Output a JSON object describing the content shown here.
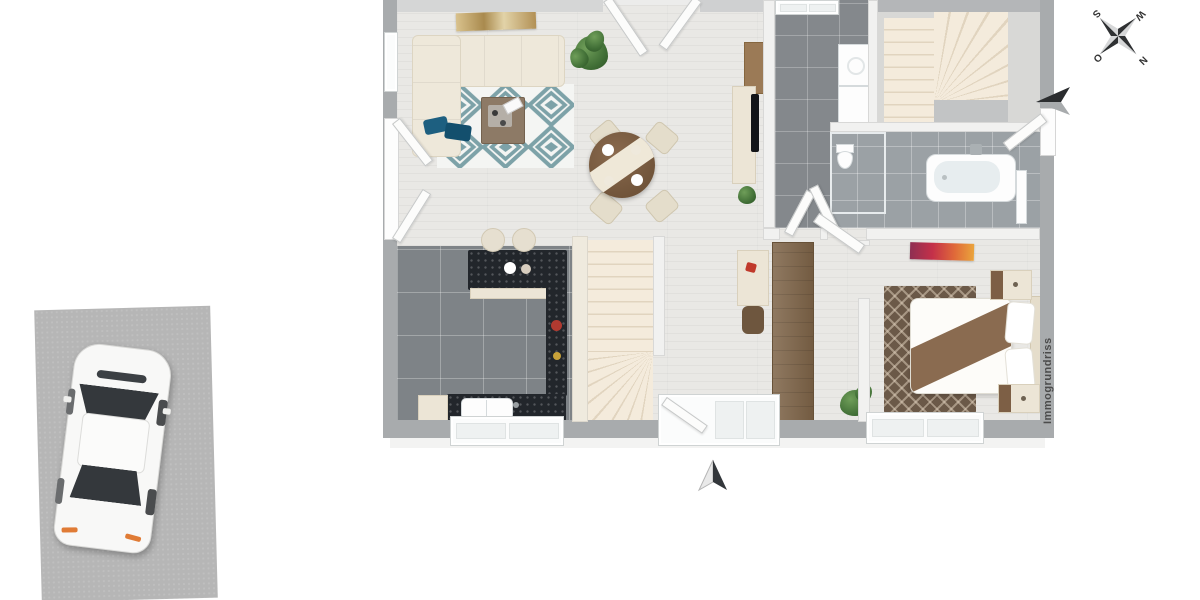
{
  "scene": {
    "type": "3d-floor-plan-render",
    "watermark": "Immogrundriss",
    "compass": {
      "north": "N",
      "east": "O",
      "south": "S",
      "west": "W"
    }
  },
  "palette": {
    "background": "#ffffff",
    "driveway": "#b6b6b6",
    "outer_wall": "#a8abad",
    "inner_wall": "#f1f1f0",
    "wood_floor": "#e9e8e5",
    "kitchen_tile": "#7e8387",
    "utility_tile": "#84888c",
    "bath_tile": "#9ba1a5",
    "stair_tread": "#f4ebdc",
    "rug_teal": "#7da2a8",
    "bedroom_rug": "#6b5948",
    "sofa_cream": "#eee8da",
    "wood_furniture": "#8a6a4e",
    "counter_black": "#22262b",
    "car_body": "#f8f8f7",
    "accent_pillow": "#1d5f80",
    "plant_green": "#4d7d42",
    "arrow_dark": "#33373b",
    "watermark_gray": "#4c4c4c"
  },
  "elements": [
    "driveway",
    "car-top-view",
    "sectional-sofa",
    "geometric-rug",
    "coffee-table",
    "wall-art",
    "potted-plant",
    "dining-table-set",
    "tv-sideboard",
    "kitchen-island",
    "bar-stools",
    "kitchen-counter",
    "kitchen-sink",
    "upper-winder-staircase",
    "lower-winder-staircase",
    "washer-dryer",
    "bathtub",
    "shower",
    "toilet",
    "hallway-wardrobe",
    "desk-and-chair",
    "double-bed",
    "nightstands",
    "bedroom-rug",
    "bedroom-art",
    "patio-doors",
    "windows",
    "entrance-arrow",
    "patio-direction-arrow",
    "compass-rose",
    "watermark"
  ]
}
